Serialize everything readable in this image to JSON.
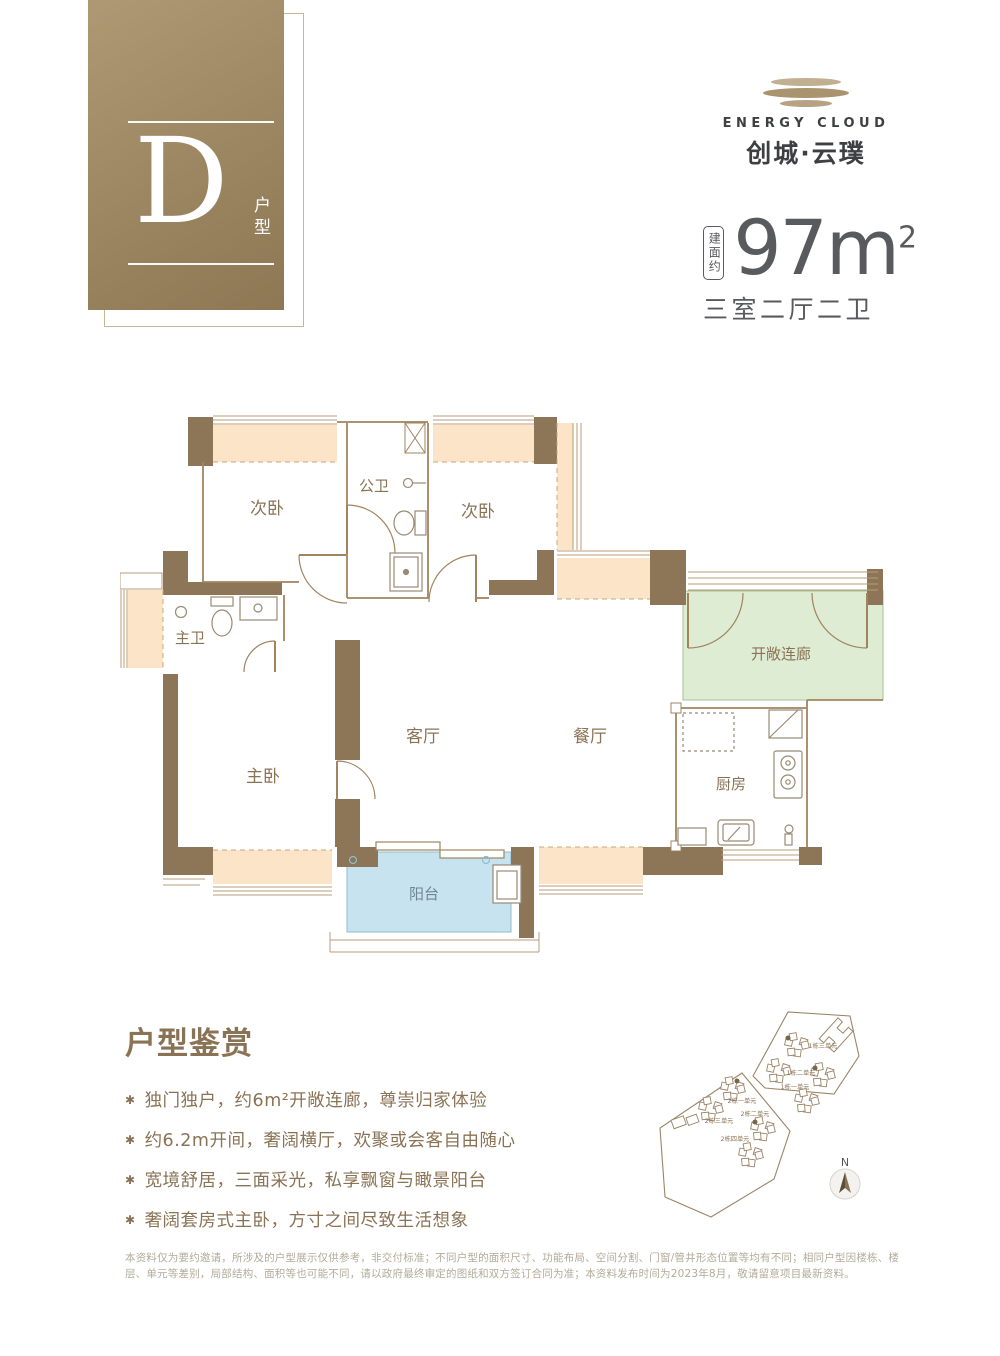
{
  "badge": {
    "letter": "D",
    "type_label": "户型"
  },
  "logo": {
    "name_en": "ENERGY CLOUD",
    "name_cn": "创城·云璞"
  },
  "area": {
    "prefix": "建面约",
    "value": "97",
    "sup": "2",
    "unit": "m",
    "layout": "三室二厅二卫"
  },
  "floorplan": {
    "rooms": {
      "bedroom_tl": "次卧",
      "bath_public": "公卫",
      "bedroom_tr": "次卧",
      "bath_master": "主卫",
      "bedroom_master": "主卧",
      "living": "客厅",
      "dining": "餐厅",
      "kitchen": "厨房",
      "corridor": "开敞连廊",
      "balcony": "阳台"
    }
  },
  "features": {
    "title": "户型鉴赏",
    "marker": "✱",
    "items": [
      "独门独户，约6m²开敞连廊，尊崇归家体验",
      "约6.2m开间，奢阔横厅，欢聚或会客自由随心",
      "宽境舒居，三面采光，私享飘窗与瞰景阳台",
      "奢阔套房式主卧，方寸之间尽致生活想象"
    ]
  },
  "siteplan": {
    "unit_labels": [
      "1栋三单元",
      "1栋二单元",
      "1栋一单元",
      "2栋一单元",
      "2栋三单元",
      "2栋二单元",
      "2栋四单元"
    ],
    "compass_label": "N"
  },
  "disclaimer": "本资料仅为要约邀请，所涉及的户型展示仅供参考，非交付标准；不同户型的面积尺寸、功能布局、空间分割、门窗/管井形态位置等均有不同；相同户型因楼栋、楼层、单元等差别，局部结构、面积等也可能不同，请以政府最终审定的图纸和双方签订合同为准；本资料发布时间为2023年8月，敬请留意项目最新资料。",
  "colors": {
    "brand_brown": "#8a7355",
    "wall": "#8d7557",
    "bay_fill": "#fbe4c8",
    "corridor_fill": "#dfecd4",
    "balcony_fill": "#c6e3ef",
    "dark_text": "#595a5e",
    "disclaimer_text": "#b3ab9a"
  }
}
